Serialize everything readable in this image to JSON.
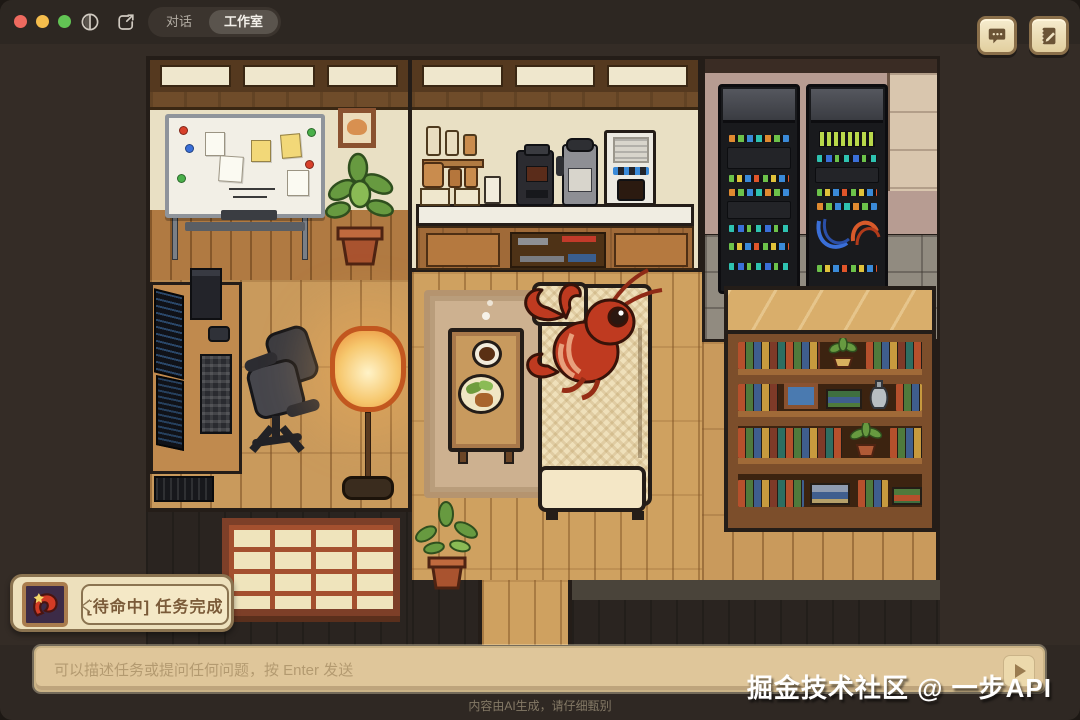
{
  "titlebar": {
    "traffic_lights": {
      "close": "#ee6a5f",
      "minimize": "#f5bd4c",
      "zoom": "#62c454"
    },
    "icons": {
      "sidebar_toggle": "circle-split-icon",
      "share": "box-arrow-icon"
    },
    "tabs": [
      {
        "label": "对话",
        "active": false
      },
      {
        "label": "工作室",
        "active": true
      }
    ]
  },
  "header_buttons": [
    {
      "name": "chat",
      "icon": "speech-bubble-icon"
    },
    {
      "name": "notes",
      "icon": "notebook-pencil-icon"
    }
  ],
  "scene": {
    "type": "pixel-art-room",
    "character": "red-lobster-mascot",
    "objects": [
      "whiteboard-with-notes",
      "cat-picture",
      "potted-plant-large",
      "desk-with-monitors",
      "pc-tower",
      "keyboard",
      "office-chair",
      "floor-lamp",
      "spice-shelf",
      "coffee-grinder",
      "kettle",
      "espresso-machine",
      "kitchen-counter",
      "lower-cabinet",
      "rug",
      "coffee-table",
      "coffee-cup",
      "snack-plate",
      "couch",
      "server-rack-left",
      "server-rack-right",
      "bookshelf",
      "shoji-window",
      "potted-plant-small"
    ]
  },
  "status_badge": {
    "avatar": "lobster-portrait",
    "state_text": "[待命中] 任务完成"
  },
  "composer": {
    "placeholder": "可以描述任务或提问任何问题，按 Enter 发送",
    "send_icon": "play-triangle-icon"
  },
  "footer": {
    "disclaimer": "内容由AI生成，请仔细甄别"
  },
  "watermark": {
    "text": "掘金技术社区 @ 一步API"
  },
  "colors": {
    "window_bg": "#2f2823",
    "wall_cream": "#e9e0c4",
    "wood_floor": "#c99a5c",
    "accent_red": "#bf3a20",
    "panel_cream": "#ede0bc",
    "input_bg": "#dfc69a"
  }
}
